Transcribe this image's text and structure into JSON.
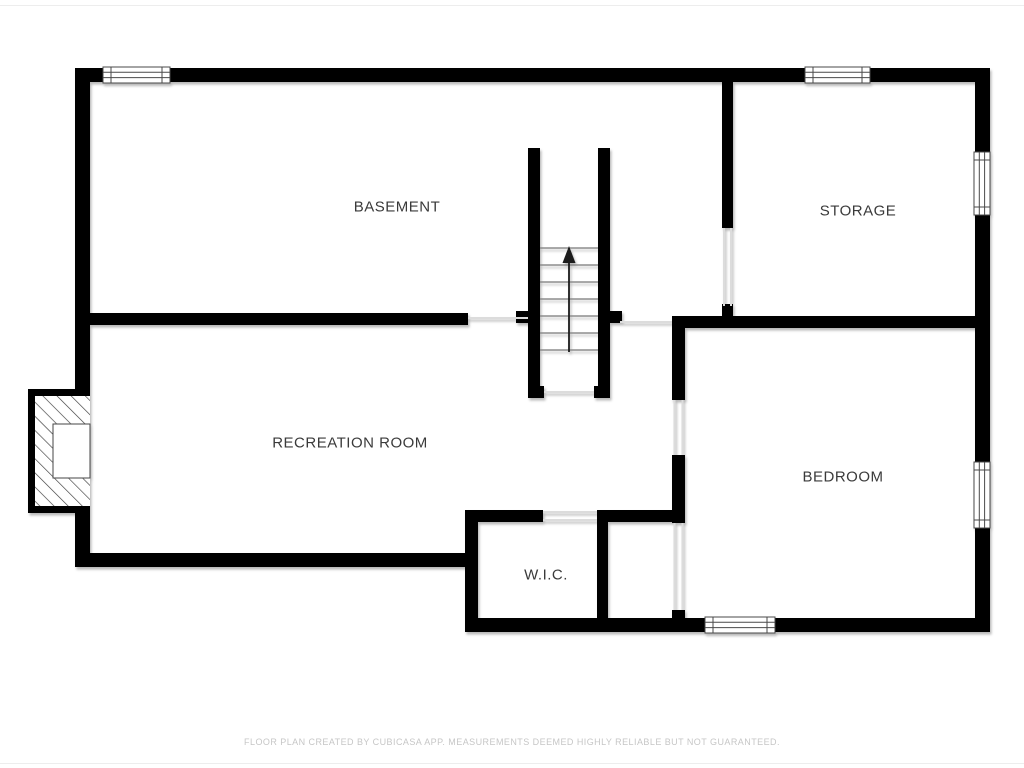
{
  "rooms": [
    {
      "id": "basement",
      "label": "BASEMENT"
    },
    {
      "id": "storage",
      "label": "STORAGE"
    },
    {
      "id": "recreation-room",
      "label": "RECREATION ROOM"
    },
    {
      "id": "bedroom",
      "label": "BEDROOM"
    },
    {
      "id": "wic",
      "label": "W.I.C."
    }
  ],
  "features": {
    "stairs_direction": "up",
    "window_count": 5,
    "fireplace": true
  },
  "footer": {
    "disclaimer": "FLOOR PLAN CREATED BY CUBICASA APP. MEASUREMENTS DEEMED HIGHLY RELIABLE BUT NOT GUARANTEED."
  },
  "colors": {
    "wall": "#000000",
    "background": "#ffffff",
    "label_text": "#3a3a3a",
    "threshold": "#dcdcdc",
    "footer_text": "#c6c6c6"
  }
}
